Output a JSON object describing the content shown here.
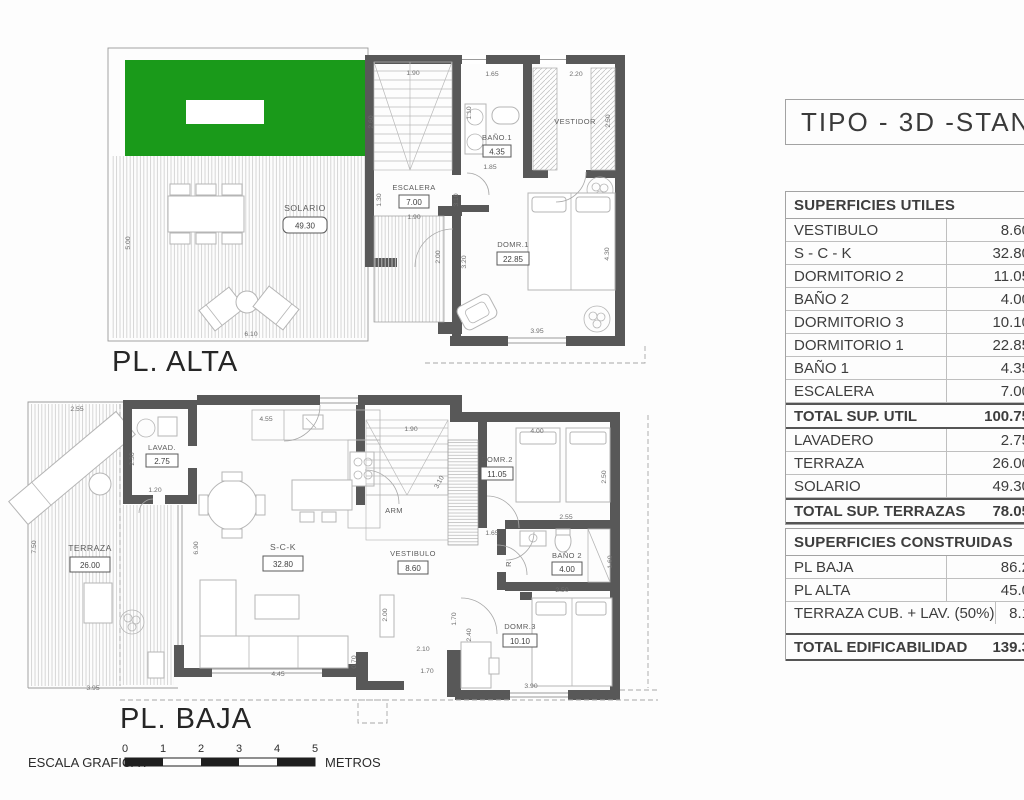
{
  "title": "TIPO - 3D -STANDAR",
  "plan_alta": {
    "label": "PL. ALTA",
    "rooms": {
      "solario": {
        "name": "SOLARIO",
        "area": "49.30"
      },
      "escalera": {
        "name": "ESCALERA",
        "area": "7.00"
      },
      "bano1": {
        "name": "BAÑO.1",
        "area": "4.35"
      },
      "vestidor": {
        "name": "VESTIDOR"
      },
      "dorm1": {
        "name": "DOMR.1",
        "area": "22.85"
      }
    },
    "dims": [
      {
        "t": "1.90",
        "x": 413,
        "y": 75
      },
      {
        "t": "1.65",
        "x": 492,
        "y": 76
      },
      {
        "t": "2.20",
        "x": 576,
        "y": 76
      },
      {
        "t": "2.60",
        "x": 373,
        "y": 122,
        "r": -90
      },
      {
        "t": "1.10",
        "x": 471,
        "y": 113,
        "r": -90
      },
      {
        "t": "2.50",
        "x": 610,
        "y": 121,
        "r": -90
      },
      {
        "t": "1.30",
        "x": 381,
        "y": 200,
        "r": -90
      },
      {
        "t": "3.10",
        "x": 458,
        "y": 200,
        "r": -90
      },
      {
        "t": "1.90",
        "x": 414,
        "y": 219
      },
      {
        "t": "1.85",
        "x": 490,
        "y": 169
      },
      {
        "t": "5.00",
        "x": 130,
        "y": 243,
        "r": -90
      },
      {
        "t": "6.10",
        "x": 251,
        "y": 336
      },
      {
        "t": "2.00",
        "x": 440,
        "y": 257,
        "r": -90
      },
      {
        "t": "3.20",
        "x": 466,
        "y": 262,
        "r": -90
      },
      {
        "t": "3.95",
        "x": 537,
        "y": 333
      },
      {
        "t": "4.30",
        "x": 609,
        "y": 254,
        "r": -90
      }
    ]
  },
  "plan_baja": {
    "label": "PL. BAJA",
    "rooms": {
      "terraza": {
        "name": "TERRAZA",
        "area": "26.00"
      },
      "lavadero": {
        "name": "LAVAD.",
        "area": "2.75"
      },
      "sck": {
        "name": "S-C-K",
        "area": "32.80"
      },
      "vestibulo": {
        "name": "VESTIBULO",
        "area": "8.60"
      },
      "dorm2": {
        "name": "DOMR.2",
        "area": "11.05"
      },
      "bano2": {
        "name": "BAÑO 2",
        "area": "4.00"
      },
      "dorm3": {
        "name": "DOMR.3",
        "area": "10.10"
      },
      "arm": {
        "name": "ARM"
      },
      "r": {
        "name": "R"
      }
    },
    "dims": [
      {
        "t": "2.55",
        "x": 77,
        "y": 411
      },
      {
        "t": "7.50",
        "x": 36,
        "y": 547,
        "r": -90
      },
      {
        "t": "3.95",
        "x": 93,
        "y": 690
      },
      {
        "t": "2.30",
        "x": 134,
        "y": 459,
        "r": -90
      },
      {
        "t": "1.20",
        "x": 155,
        "y": 492
      },
      {
        "t": "4.55",
        "x": 266,
        "y": 421
      },
      {
        "t": "6.90",
        "x": 198,
        "y": 548,
        "r": -90
      },
      {
        "t": "4.45",
        "x": 278,
        "y": 676
      },
      {
        "t": "0.70",
        "x": 356,
        "y": 662,
        "r": -90
      },
      {
        "t": "1.90",
        "x": 411,
        "y": 431
      },
      {
        "t": "3.10",
        "x": 441,
        "y": 483,
        "r": -62
      },
      {
        "t": "1.65",
        "x": 492,
        "y": 535
      },
      {
        "t": "2.55",
        "x": 566,
        "y": 519
      },
      {
        "t": "4.00",
        "x": 537,
        "y": 433
      },
      {
        "t": "2.50",
        "x": 606,
        "y": 477,
        "r": -90
      },
      {
        "t": "2.50",
        "x": 562,
        "y": 592
      },
      {
        "t": "1.60",
        "x": 612,
        "y": 562,
        "r": -90
      },
      {
        "t": "2.10",
        "x": 423,
        "y": 651
      },
      {
        "t": "1.70",
        "x": 427,
        "y": 673
      },
      {
        "t": "1.70",
        "x": 456,
        "y": 619,
        "r": -90
      },
      {
        "t": "2.40",
        "x": 471,
        "y": 635,
        "r": -90
      },
      {
        "t": "3.90",
        "x": 531,
        "y": 688
      },
      {
        "t": "2.00",
        "x": 387,
        "y": 615,
        "r": -90
      }
    ]
  },
  "tables": {
    "utiles": {
      "header": "SUPERFICIES UTILES",
      "rows": [
        {
          "label": "VESTIBULO",
          "value": "8.60"
        },
        {
          "label": "S - C - K",
          "value": "32.80"
        },
        {
          "label": "DORMITORIO 2",
          "value": "11.05"
        },
        {
          "label": "BAÑO 2",
          "value": "4.00"
        },
        {
          "label": "DORMITORIO 3",
          "value": "10.10"
        },
        {
          "label": "DORMITORIO 1",
          "value": "22.85"
        },
        {
          "label": "BAÑO 1",
          "value": "4.35"
        },
        {
          "label": "ESCALERA",
          "value": "7.00"
        },
        {
          "label": "TOTAL SUP. UTIL",
          "value": "100.75",
          "total": true
        },
        {
          "label": "LAVADERO",
          "value": "2.75"
        },
        {
          "label": "TERRAZA",
          "value": "26.00"
        },
        {
          "label": "SOLARIO",
          "value": "49.30"
        },
        {
          "label": "TOTAL SUP. TERRAZAS",
          "value": "78.05",
          "total": true
        }
      ]
    },
    "construidas": {
      "header": "SUPERFICIES CONSTRUIDAS",
      "rows": [
        {
          "label": "PL BAJA",
          "value": "86.2"
        },
        {
          "label": "PL ALTA",
          "value": "45.0"
        },
        {
          "label": "TERRAZA CUB. + LAV. (50%)",
          "value": "8.1"
        }
      ],
      "total_row": {
        "label": "TOTAL EDIFICABILIDAD",
        "value": "139.3"
      }
    }
  },
  "scale_bar": {
    "label": "ESCALA GRAFICA :",
    "unit": "METROS",
    "ticks": [
      {
        "t": "0",
        "x": 125,
        "y": 752,
        "c": "tick"
      },
      {
        "t": "1",
        "x": 163,
        "y": 752,
        "c": "tick"
      },
      {
        "t": "2",
        "x": 201,
        "y": 752,
        "c": "tick"
      },
      {
        "t": "3",
        "x": 239,
        "y": 752,
        "c": "tick"
      },
      {
        "t": "4",
        "x": 277,
        "y": 752,
        "c": "tick"
      },
      {
        "t": "5",
        "x": 315,
        "y": 752,
        "c": "tick"
      }
    ]
  },
  "colors": {
    "grass": "#1a9a1a",
    "wall": "#585858"
  }
}
